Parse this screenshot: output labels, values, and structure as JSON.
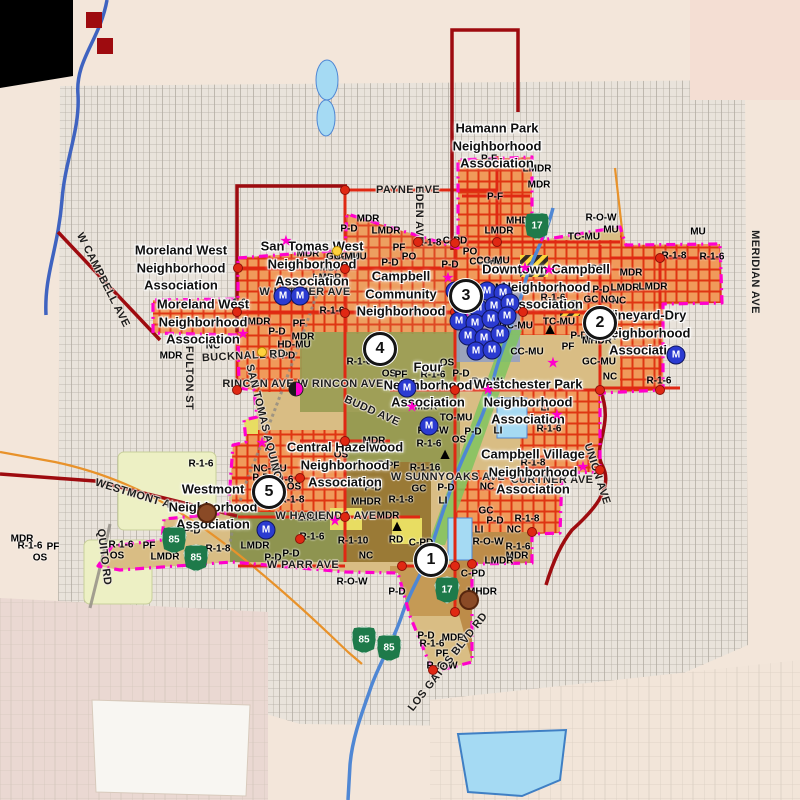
{
  "map": {
    "city": "Campbell",
    "colors": {
      "city_boundary": "#ff00cc",
      "major_road": "#e02813",
      "county_line": "#9e0b0f",
      "residential_zone": "#f09a5a",
      "water": "#a5daf3",
      "creek": "#4f87d4",
      "highway_shield": "#1e7a4a",
      "m_marker": "#2b3bd1",
      "outer_land": "#f3e6da"
    },
    "neighborhood_labels": [
      {
        "text": "Hamann Park\nNeighborhood\nAssociation",
        "x": 497,
        "y": 146
      },
      {
        "text": "Moreland West\nNeighborhood\nAssociation",
        "x": 181,
        "y": 268
      },
      {
        "text": "San Tomas West\nNeighborhood\nAssociation",
        "x": 312,
        "y": 264
      },
      {
        "text": "Moreland West\nNeighborhood\nAssociation",
        "x": 203,
        "y": 322
      },
      {
        "text": "Campbell\nCommunity\nNeighborhood",
        "x": 401,
        "y": 294
      },
      {
        "text": "Downtown Campbell\nNeighborhood\nAssociation",
        "x": 546,
        "y": 287
      },
      {
        "text": "Vineyard-Dry\nNeighborhood\nAssociation",
        "x": 646,
        "y": 333
      },
      {
        "text": "Four\nNeighborhood\nAssociation",
        "x": 428,
        "y": 385
      },
      {
        "text": "Westchester Park\nNeighborhood\nAssociation",
        "x": 528,
        "y": 402
      },
      {
        "text": "Central Hazelwood\nNeighborhood\nAssociation",
        "x": 345,
        "y": 465
      },
      {
        "text": "Campbell Village\nNeighborhood\nAssociation",
        "x": 533,
        "y": 472
      },
      {
        "text": "Westmont\nNeighborhood\nAssociation",
        "x": 213,
        "y": 507
      }
    ],
    "street_labels": [
      {
        "text": "PAYNE AVE",
        "x": 408,
        "y": 190,
        "rot": 0
      },
      {
        "text": "EDEN AVE",
        "x": 419,
        "y": 215,
        "rot": 90
      },
      {
        "text": "MERIDIAN AVE",
        "x": 755,
        "y": 272,
        "rot": 90
      },
      {
        "text": "W CAMPBELL AVE",
        "x": 103,
        "y": 280,
        "rot": 63
      },
      {
        "text": "FULTON ST",
        "x": 189,
        "y": 378,
        "rot": 90
      },
      {
        "text": "BUCKNALL RD",
        "x": 244,
        "y": 356,
        "rot": -3
      },
      {
        "text": "RINCON AVE W RINCON AVE",
        "x": 303,
        "y": 384,
        "rot": 0
      },
      {
        "text": "W LATIMER AVE",
        "x": 305,
        "y": 292,
        "rot": 0
      },
      {
        "text": "SAN TOMAS AQUINO RD",
        "x": 266,
        "y": 432,
        "rot": 76
      },
      {
        "text": "BUDD AVE",
        "x": 372,
        "y": 411,
        "rot": 24
      },
      {
        "text": "W SUNNYOAKS AVE",
        "x": 448,
        "y": 477,
        "rot": 0
      },
      {
        "text": "W HACIENDA AVE",
        "x": 326,
        "y": 516,
        "rot": 0
      },
      {
        "text": "W PARR AVE",
        "x": 303,
        "y": 565,
        "rot": 0
      },
      {
        "text": "WESTMONT AVE",
        "x": 140,
        "y": 496,
        "rot": 17
      },
      {
        "text": "QUITO RD",
        "x": 104,
        "y": 557,
        "rot": 83
      },
      {
        "text": "CURTNER AVE",
        "x": 552,
        "y": 480,
        "rot": 0
      },
      {
        "text": "UNION AVE",
        "x": 597,
        "y": 474,
        "rot": 72
      },
      {
        "text": "LOS GATOS BLVD RD",
        "x": 448,
        "y": 662,
        "rot": -52
      }
    ],
    "zoning_labels": [
      {
        "code": "P-F",
        "x": 489,
        "y": 159
      },
      {
        "code": "LMDR",
        "x": 537,
        "y": 169
      },
      {
        "code": "MDR",
        "x": 539,
        "y": 185
      },
      {
        "code": "P-F",
        "x": 495,
        "y": 197
      },
      {
        "code": "MHDR",
        "x": 521,
        "y": 221
      },
      {
        "code": "LMDR",
        "x": 499,
        "y": 231
      },
      {
        "code": "R-O-W",
        "x": 601,
        "y": 218
      },
      {
        "code": "MU",
        "x": 611,
        "y": 230
      },
      {
        "code": "TC-MU",
        "x": 584,
        "y": 237
      },
      {
        "code": "MDR",
        "x": 368,
        "y": 219
      },
      {
        "code": "P-D",
        "x": 349,
        "y": 229
      },
      {
        "code": "LMDR",
        "x": 386,
        "y": 231
      },
      {
        "code": "R-1-8",
        "x": 429,
        "y": 243
      },
      {
        "code": "C-PD",
        "x": 455,
        "y": 241
      },
      {
        "code": "PF",
        "x": 399,
        "y": 248
      },
      {
        "code": "PO",
        "x": 409,
        "y": 257
      },
      {
        "code": "P-D",
        "x": 390,
        "y": 263
      },
      {
        "code": "PO",
        "x": 470,
        "y": 252
      },
      {
        "code": "P-D",
        "x": 450,
        "y": 265
      },
      {
        "code": "CC-MU",
        "x": 486,
        "y": 262
      },
      {
        "code": "NC-MU",
        "x": 350,
        "y": 257
      },
      {
        "code": "MDR",
        "x": 308,
        "y": 254
      },
      {
        "code": "GC-MU",
        "x": 343,
        "y": 257
      },
      {
        "code": "MDR",
        "x": 331,
        "y": 268
      },
      {
        "code": "LMDR",
        "x": 327,
        "y": 278
      },
      {
        "code": "R-1-6",
        "x": 234,
        "y": 303
      },
      {
        "code": "R-1-6",
        "x": 332,
        "y": 311
      },
      {
        "code": "LMDR",
        "x": 256,
        "y": 322
      },
      {
        "code": "PF",
        "x": 299,
        "y": 324
      },
      {
        "code": "P-D",
        "x": 277,
        "y": 332
      },
      {
        "code": "MDR",
        "x": 303,
        "y": 337
      },
      {
        "code": "NC",
        "x": 213,
        "y": 346
      },
      {
        "code": "HD-MU",
        "x": 294,
        "y": 345
      },
      {
        "code": "C-PD",
        "x": 283,
        "y": 356
      },
      {
        "code": "MDR",
        "x": 171,
        "y": 356
      },
      {
        "code": "R-1-6",
        "x": 359,
        "y": 362
      },
      {
        "code": "OS",
        "x": 389,
        "y": 374
      },
      {
        "code": "CC-MU",
        "x": 493,
        "y": 261
      },
      {
        "code": "P-D",
        "x": 578,
        "y": 271
      },
      {
        "code": "OS",
        "x": 597,
        "y": 269
      },
      {
        "code": "MDR",
        "x": 631,
        "y": 273
      },
      {
        "code": "LMDR",
        "x": 625,
        "y": 288
      },
      {
        "code": "MHDR",
        "x": 510,
        "y": 288
      },
      {
        "code": "P-D",
        "x": 601,
        "y": 290
      },
      {
        "code": "NC",
        "x": 619,
        "y": 301
      },
      {
        "code": "GC",
        "x": 591,
        "y": 300
      },
      {
        "code": "R-1-6",
        "x": 553,
        "y": 298
      },
      {
        "code": "TC-MU",
        "x": 559,
        "y": 322
      },
      {
        "code": "GC-MU",
        "x": 516,
        "y": 326
      },
      {
        "code": "P-D",
        "x": 579,
        "y": 336
      },
      {
        "code": "MHDR",
        "x": 597,
        "y": 341
      },
      {
        "code": "PF",
        "x": 568,
        "y": 347
      },
      {
        "code": "GC-MU",
        "x": 599,
        "y": 362
      },
      {
        "code": "CC-MU",
        "x": 527,
        "y": 352
      },
      {
        "code": "NC",
        "x": 608,
        "y": 300
      },
      {
        "code": "MHDR",
        "x": 601,
        "y": 337
      },
      {
        "code": "NC",
        "x": 610,
        "y": 377
      },
      {
        "code": "R-1-6",
        "x": 659,
        "y": 381
      },
      {
        "code": "R-1-8",
        "x": 674,
        "y": 256
      },
      {
        "code": "R-1-6",
        "x": 712,
        "y": 257
      },
      {
        "code": "LMDR",
        "x": 653,
        "y": 287
      },
      {
        "code": "MU",
        "x": 698,
        "y": 232
      },
      {
        "code": "PF",
        "x": 401,
        "y": 375
      },
      {
        "code": "R-1-6",
        "x": 433,
        "y": 375
      },
      {
        "code": "P-D",
        "x": 461,
        "y": 374
      },
      {
        "code": "MDR",
        "x": 426,
        "y": 407
      },
      {
        "code": "TO-MU",
        "x": 456,
        "y": 418
      },
      {
        "code": "R-O-W",
        "x": 433,
        "y": 431
      },
      {
        "code": "P-D",
        "x": 473,
        "y": 432
      },
      {
        "code": "LI",
        "x": 498,
        "y": 431
      },
      {
        "code": "OS",
        "x": 459,
        "y": 440
      },
      {
        "code": "OS",
        "x": 491,
        "y": 404
      },
      {
        "code": "LI",
        "x": 545,
        "y": 408
      },
      {
        "code": "R-O-W",
        "x": 487,
        "y": 382
      },
      {
        "code": "R-1-6",
        "x": 429,
        "y": 444
      },
      {
        "code": "PF",
        "x": 393,
        "y": 466
      },
      {
        "code": "R-1-16",
        "x": 425,
        "y": 468
      },
      {
        "code": "OS",
        "x": 447,
        "y": 363
      },
      {
        "code": "R-1-8",
        "x": 533,
        "y": 463
      },
      {
        "code": "R-1-6",
        "x": 549,
        "y": 429
      },
      {
        "code": "GC",
        "x": 486,
        "y": 511
      },
      {
        "code": "P-D",
        "x": 495,
        "y": 521
      },
      {
        "code": "R-1-8",
        "x": 527,
        "y": 519
      },
      {
        "code": "NC",
        "x": 514,
        "y": 530
      },
      {
        "code": "LI",
        "x": 479,
        "y": 530
      },
      {
        "code": "R-O-W",
        "x": 488,
        "y": 542
      },
      {
        "code": "R-1-6",
        "x": 518,
        "y": 547
      },
      {
        "code": "MDR",
        "x": 517,
        "y": 556
      },
      {
        "code": "NC",
        "x": 487,
        "y": 487
      },
      {
        "code": "MDR",
        "x": 374,
        "y": 441
      },
      {
        "code": "NC-MU",
        "x": 270,
        "y": 469
      },
      {
        "code": "P-D",
        "x": 261,
        "y": 478
      },
      {
        "code": "R-1-6",
        "x": 281,
        "y": 480
      },
      {
        "code": "OS",
        "x": 294,
        "y": 487
      },
      {
        "code": "R-1-8",
        "x": 292,
        "y": 500
      },
      {
        "code": "MHDR",
        "x": 366,
        "y": 502
      },
      {
        "code": "R-1-8",
        "x": 401,
        "y": 500
      },
      {
        "code": "GC",
        "x": 419,
        "y": 489
      },
      {
        "code": "P-D",
        "x": 446,
        "y": 488
      },
      {
        "code": "LI",
        "x": 443,
        "y": 501
      },
      {
        "code": "P-D",
        "x": 373,
        "y": 488
      },
      {
        "code": "MDR",
        "x": 388,
        "y": 516
      },
      {
        "code": "LMDR",
        "x": 312,
        "y": 518
      },
      {
        "code": "R-1-6",
        "x": 312,
        "y": 537
      },
      {
        "code": "R-1-10",
        "x": 353,
        "y": 541
      },
      {
        "code": "C-PD",
        "x": 421,
        "y": 543
      },
      {
        "code": "RD",
        "x": 396,
        "y": 540
      },
      {
        "code": "OS",
        "x": 341,
        "y": 455
      },
      {
        "code": "PF",
        "x": 384,
        "y": 465
      },
      {
        "code": "R-1-6",
        "x": 121,
        "y": 545
      },
      {
        "code": "PF",
        "x": 149,
        "y": 546
      },
      {
        "code": "OS",
        "x": 117,
        "y": 556
      },
      {
        "code": "LMDR",
        "x": 165,
        "y": 557
      },
      {
        "code": "P-D",
        "x": 192,
        "y": 531
      },
      {
        "code": "R-1-8",
        "x": 218,
        "y": 549
      },
      {
        "code": "LMDR",
        "x": 255,
        "y": 546
      },
      {
        "code": "R-1-6",
        "x": 201,
        "y": 464
      },
      {
        "code": "P-D",
        "x": 273,
        "y": 558
      },
      {
        "code": "R-1-6",
        "x": 30,
        "y": 546
      },
      {
        "code": "PF",
        "x": 53,
        "y": 547
      },
      {
        "code": "OS",
        "x": 40,
        "y": 558
      },
      {
        "code": "MDR",
        "x": 22,
        "y": 539
      },
      {
        "code": "NC",
        "x": 366,
        "y": 556
      },
      {
        "code": "P-D",
        "x": 291,
        "y": 554
      },
      {
        "code": "R-O-W",
        "x": 352,
        "y": 582
      },
      {
        "code": "P-D",
        "x": 397,
        "y": 592
      },
      {
        "code": "C-PD",
        "x": 473,
        "y": 574
      },
      {
        "code": "MHDR",
        "x": 482,
        "y": 592
      },
      {
        "code": "P-D",
        "x": 426,
        "y": 636
      },
      {
        "code": "R-1-6",
        "x": 432,
        "y": 644
      },
      {
        "code": "MDR",
        "x": 453,
        "y": 638
      },
      {
        "code": "PF",
        "x": 442,
        "y": 654
      },
      {
        "code": "R-O-W",
        "x": 442,
        "y": 666
      },
      {
        "code": "LMDR",
        "x": 499,
        "y": 561
      }
    ],
    "area_numbers": [
      {
        "n": "1",
        "x": 431,
        "y": 560
      },
      {
        "n": "2",
        "x": 600,
        "y": 323
      },
      {
        "n": "3",
        "x": 466,
        "y": 296
      },
      {
        "n": "4",
        "x": 380,
        "y": 349
      },
      {
        "n": "5",
        "x": 269,
        "y": 492
      }
    ],
    "highway_shields": [
      {
        "route": "17",
        "x": 537,
        "y": 226
      },
      {
        "route": "17",
        "x": 447,
        "y": 590
      },
      {
        "route": "85",
        "x": 174,
        "y": 540
      },
      {
        "route": "85",
        "x": 196,
        "y": 558
      },
      {
        "route": "85",
        "x": 364,
        "y": 640
      },
      {
        "route": "85",
        "x": 389,
        "y": 648
      }
    ],
    "m_markers": [
      {
        "x": 455,
        "y": 291
      },
      {
        "x": 471,
        "y": 293
      },
      {
        "x": 487,
        "y": 291
      },
      {
        "x": 503,
        "y": 293
      },
      {
        "x": 462,
        "y": 306
      },
      {
        "x": 478,
        "y": 308
      },
      {
        "x": 494,
        "y": 306
      },
      {
        "x": 510,
        "y": 303
      },
      {
        "x": 459,
        "y": 321
      },
      {
        "x": 475,
        "y": 323
      },
      {
        "x": 491,
        "y": 319
      },
      {
        "x": 507,
        "y": 316
      },
      {
        "x": 468,
        "y": 336
      },
      {
        "x": 484,
        "y": 338
      },
      {
        "x": 500,
        "y": 334
      },
      {
        "x": 476,
        "y": 351
      },
      {
        "x": 492,
        "y": 350
      },
      {
        "x": 283,
        "y": 296
      },
      {
        "x": 300,
        "y": 296
      },
      {
        "x": 676,
        "y": 355
      },
      {
        "x": 407,
        "y": 388
      },
      {
        "x": 266,
        "y": 530
      },
      {
        "x": 429,
        "y": 426
      }
    ],
    "star_markers": [
      {
        "x": 286,
        "y": 241
      },
      {
        "x": 448,
        "y": 278
      },
      {
        "x": 525,
        "y": 268
      },
      {
        "x": 549,
        "y": 270
      },
      {
        "x": 465,
        "y": 312
      },
      {
        "x": 243,
        "y": 334
      },
      {
        "x": 553,
        "y": 363
      },
      {
        "x": 488,
        "y": 390
      },
      {
        "x": 412,
        "y": 407
      },
      {
        "x": 557,
        "y": 415
      },
      {
        "x": 262,
        "y": 443
      },
      {
        "x": 273,
        "y": 487
      },
      {
        "x": 583,
        "y": 467
      },
      {
        "x": 335,
        "y": 521
      }
    ],
    "triangle_markers": [
      {
        "x": 550,
        "y": 330
      },
      {
        "x": 445,
        "y": 455
      },
      {
        "x": 397,
        "y": 527
      }
    ],
    "landmark_markers": [
      {
        "x": 207,
        "y": 513
      },
      {
        "x": 469,
        "y": 600
      }
    ],
    "pie_markers": [
      {
        "x": 296,
        "y": 389
      }
    ],
    "signal_dots": [
      {
        "x": 345,
        "y": 269
      },
      {
        "x": 345,
        "y": 313
      },
      {
        "x": 455,
        "y": 243
      },
      {
        "x": 455,
        "y": 312
      },
      {
        "x": 497,
        "y": 242
      },
      {
        "x": 455,
        "y": 390
      },
      {
        "x": 345,
        "y": 441
      },
      {
        "x": 300,
        "y": 478
      },
      {
        "x": 345,
        "y": 517
      },
      {
        "x": 402,
        "y": 566
      },
      {
        "x": 455,
        "y": 566
      },
      {
        "x": 455,
        "y": 612
      },
      {
        "x": 237,
        "y": 312
      },
      {
        "x": 600,
        "y": 312
      },
      {
        "x": 600,
        "y": 390
      },
      {
        "x": 660,
        "y": 390
      },
      {
        "x": 237,
        "y": 390
      },
      {
        "x": 345,
        "y": 190
      },
      {
        "x": 523,
        "y": 312
      },
      {
        "x": 300,
        "y": 539
      },
      {
        "x": 418,
        "y": 242
      },
      {
        "x": 238,
        "y": 268
      },
      {
        "x": 660,
        "y": 258
      },
      {
        "x": 600,
        "y": 470
      },
      {
        "x": 532,
        "y": 532
      },
      {
        "x": 472,
        "y": 564
      },
      {
        "x": 433,
        "y": 670
      }
    ],
    "school_dots": [
      {
        "x": 337,
        "y": 251
      },
      {
        "x": 262,
        "y": 352
      }
    ]
  }
}
